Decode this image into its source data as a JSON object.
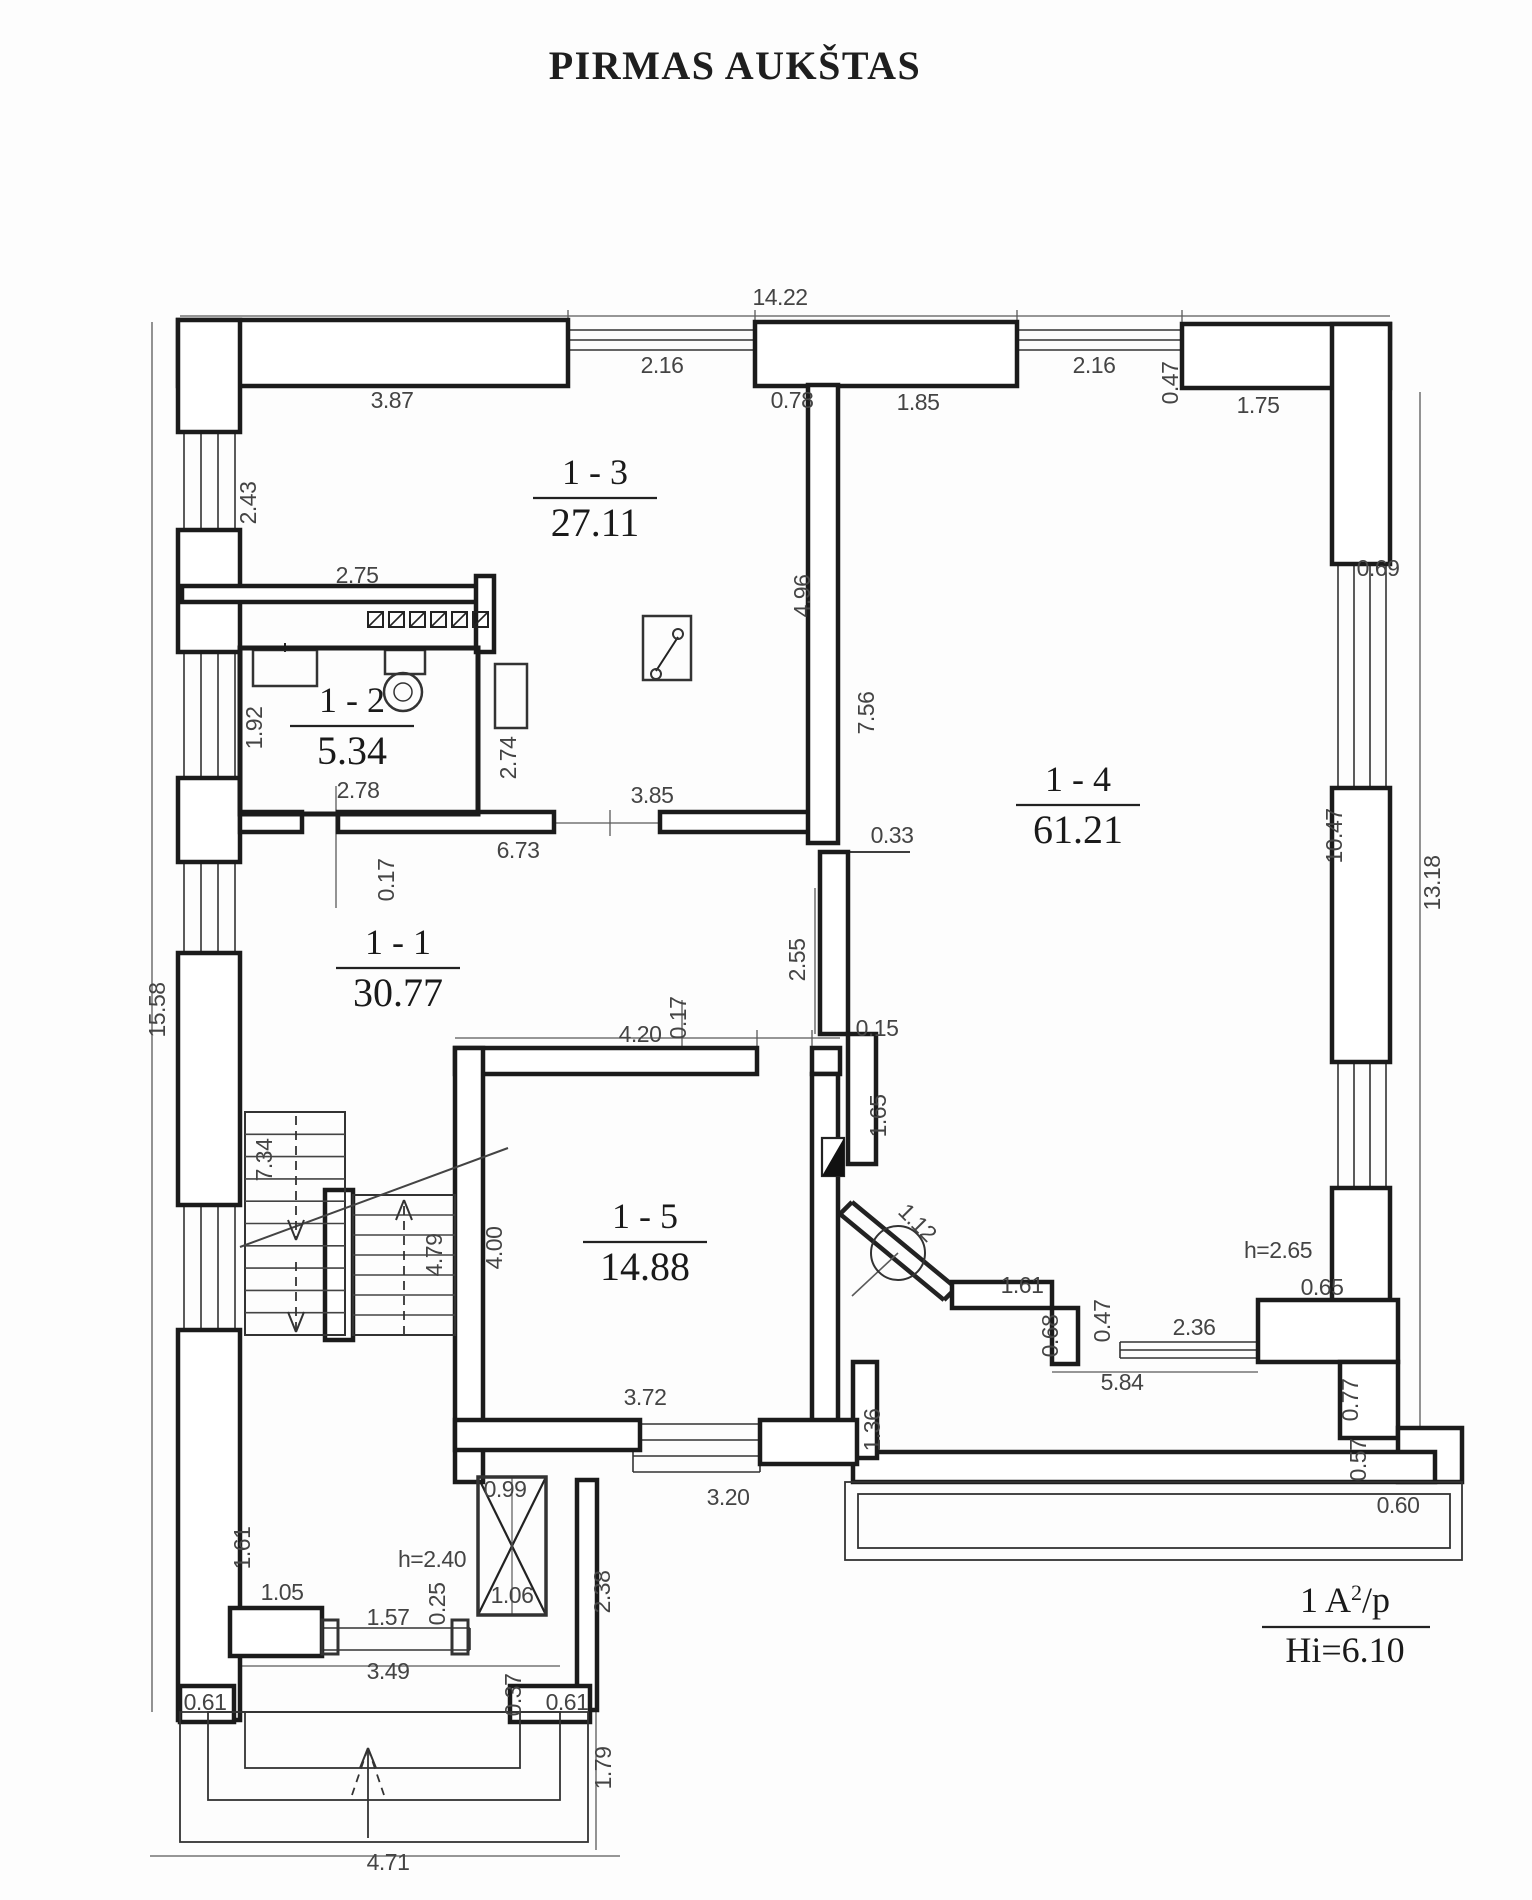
{
  "title": "PIRMAS AUKŠTAS",
  "legend": {
    "l1a": "1  A",
    "l1sup": "2",
    "l1b": "/p",
    "l2": "Hi=6.10"
  },
  "rooms": [
    {
      "name": "1 - 1",
      "area": "30.77",
      "cx": 398,
      "cy": 968
    },
    {
      "name": "1 - 2",
      "area": "5.34",
      "cx": 352,
      "cy": 726
    },
    {
      "name": "1 - 3",
      "area": "27.11",
      "cx": 595,
      "cy": 498
    },
    {
      "name": "1 - 4",
      "area": "61.21",
      "cx": 1078,
      "cy": 805
    },
    {
      "name": "1 - 5",
      "area": "14.88",
      "cx": 645,
      "cy": 1242
    }
  ],
  "dims": [
    {
      "t": "14.22",
      "x": 780,
      "y": 305
    },
    {
      "t": "2.16",
      "x": 662,
      "y": 373
    },
    {
      "t": "0.78",
      "x": 792,
      "y": 408
    },
    {
      "t": "1.85",
      "x": 918,
      "y": 410
    },
    {
      "t": "2.16",
      "x": 1094,
      "y": 373
    },
    {
      "t": "0.47",
      "x": 1178,
      "y": 383,
      "r": -90
    },
    {
      "t": "1.75",
      "x": 1258,
      "y": 413
    },
    {
      "t": "3.87",
      "x": 392,
      "y": 408
    },
    {
      "t": "2.43",
      "x": 256,
      "y": 503,
      "r": -90
    },
    {
      "t": "2.75",
      "x": 357,
      "y": 583
    },
    {
      "t": "1.92",
      "x": 262,
      "y": 728,
      "r": -90
    },
    {
      "t": "2.74",
      "x": 516,
      "y": 758,
      "r": -90
    },
    {
      "t": "2.78",
      "x": 358,
      "y": 798
    },
    {
      "t": "3.85",
      "x": 652,
      "y": 803
    },
    {
      "t": "6.73",
      "x": 518,
      "y": 858
    },
    {
      "t": "0.17",
      "x": 394,
      "y": 880,
      "r": -90
    },
    {
      "t": "4.96",
      "x": 810,
      "y": 596,
      "r": -90
    },
    {
      "t": "7.56",
      "x": 874,
      "y": 713,
      "r": -90
    },
    {
      "t": "0.33",
      "x": 892,
      "y": 843
    },
    {
      "t": "2.55",
      "x": 805,
      "y": 960,
      "r": -90
    },
    {
      "t": "0.69",
      "x": 1378,
      "y": 576
    },
    {
      "t": "10.47",
      "x": 1342,
      "y": 836,
      "r": -90
    },
    {
      "t": "13.18",
      "x": 1440,
      "y": 883,
      "r": -90
    },
    {
      "t": "15.58",
      "x": 165,
      "y": 1010,
      "r": -90
    },
    {
      "t": "0.17",
      "x": 686,
      "y": 1018,
      "r": -90
    },
    {
      "t": "4.20",
      "x": 640,
      "y": 1042
    },
    {
      "t": "0.15",
      "x": 877,
      "y": 1036
    },
    {
      "t": "1.65",
      "x": 886,
      "y": 1116,
      "r": -90
    },
    {
      "t": "1.12",
      "x": 912,
      "y": 1228,
      "r": 45
    },
    {
      "t": "4.00",
      "x": 502,
      "y": 1248,
      "r": -90
    },
    {
      "t": "4.79",
      "x": 442,
      "y": 1255,
      "r": -90
    },
    {
      "t": "7.34",
      "x": 272,
      "y": 1160,
      "r": -90
    },
    {
      "t": "h=2.65",
      "x": 1278,
      "y": 1258
    },
    {
      "t": "1.61",
      "x": 1022,
      "y": 1293
    },
    {
      "t": "0.65",
      "x": 1322,
      "y": 1295
    },
    {
      "t": "0.68",
      "x": 1058,
      "y": 1336,
      "r": -90
    },
    {
      "t": "0.47",
      "x": 1110,
      "y": 1321,
      "r": -90
    },
    {
      "t": "2.36",
      "x": 1194,
      "y": 1335
    },
    {
      "t": "5.84",
      "x": 1122,
      "y": 1390
    },
    {
      "t": "0.77",
      "x": 1358,
      "y": 1400,
      "r": -90
    },
    {
      "t": "0.57",
      "x": 1366,
      "y": 1460,
      "r": -90
    },
    {
      "t": "0.60",
      "x": 1398,
      "y": 1513
    },
    {
      "t": "1.36",
      "x": 880,
      "y": 1430,
      "r": -90
    },
    {
      "t": "3.72",
      "x": 645,
      "y": 1405
    },
    {
      "t": "3.20",
      "x": 728,
      "y": 1505
    },
    {
      "t": "0.99",
      "x": 505,
      "y": 1497
    },
    {
      "t": "h=2.40",
      "x": 432,
      "y": 1567
    },
    {
      "t": "0.25",
      "x": 445,
      "y": 1604,
      "r": -90
    },
    {
      "t": "1.06",
      "x": 512,
      "y": 1603
    },
    {
      "t": "2.38",
      "x": 610,
      "y": 1592,
      "r": -90
    },
    {
      "t": "1.61",
      "x": 250,
      "y": 1548,
      "r": -90
    },
    {
      "t": "1.05",
      "x": 282,
      "y": 1600
    },
    {
      "t": "1.57",
      "x": 388,
      "y": 1625
    },
    {
      "t": "3.49",
      "x": 388,
      "y": 1679
    },
    {
      "t": "0.61",
      "x": 205,
      "y": 1710
    },
    {
      "t": "0.37",
      "x": 521,
      "y": 1695,
      "r": -90
    },
    {
      "t": "0.61",
      "x": 567,
      "y": 1710
    },
    {
      "t": "1.79",
      "x": 611,
      "y": 1768,
      "r": -90
    },
    {
      "t": "4.71",
      "x": 388,
      "y": 1870
    }
  ],
  "geometry": {
    "bands": [
      [
        178,
        320,
        390,
        66
      ],
      [
        755,
        322,
        262,
        64
      ],
      [
        1182,
        324,
        208,
        64
      ],
      [
        1332,
        324,
        58,
        240
      ],
      [
        1332,
        788,
        58,
        274
      ],
      [
        1332,
        1188,
        58,
        114
      ],
      [
        1258,
        1300,
        140,
        62
      ],
      [
        1340,
        1362,
        58,
        76
      ],
      [
        1398,
        1428,
        64,
        54
      ],
      [
        853,
        1452,
        582,
        30
      ],
      [
        853,
        1362,
        24,
        96
      ],
      [
        178,
        320,
        62,
        112
      ],
      [
        178,
        530,
        62,
        122
      ],
      [
        178,
        778,
        62,
        84
      ],
      [
        178,
        953,
        62,
        252
      ],
      [
        178,
        1330,
        62,
        390
      ],
      [
        182,
        586,
        310,
        16
      ],
      [
        476,
        576,
        18,
        76
      ],
      [
        240,
        812,
        62,
        20
      ],
      [
        338,
        812,
        216,
        20
      ],
      [
        660,
        812,
        150,
        20
      ],
      [
        808,
        385,
        30,
        458
      ],
      [
        820,
        852,
        28,
        182
      ],
      [
        848,
        1034,
        28,
        130
      ],
      [
        952,
        1282,
        100,
        26
      ],
      [
        1052,
        1308,
        26,
        56
      ],
      [
        455,
        1048,
        302,
        26
      ],
      [
        812,
        1048,
        28,
        26
      ],
      [
        455,
        1048,
        28,
        434
      ],
      [
        812,
        1074,
        26,
        348
      ],
      [
        455,
        1420,
        185,
        30
      ],
      [
        760,
        1420,
        97,
        44
      ],
      [
        230,
        1608,
        92,
        48
      ],
      [
        577,
        1480,
        20,
        230
      ],
      [
        180,
        1686,
        54,
        36
      ],
      [
        510,
        1686,
        80,
        36
      ],
      [
        325,
        1190,
        28,
        150
      ]
    ],
    "windows": [
      {
        "o": "h",
        "a": 568,
        "b": 755,
        "p": 330,
        "n": 3,
        "g": 10
      },
      {
        "o": "h",
        "a": 1017,
        "b": 1182,
        "p": 330,
        "n": 3,
        "g": 10
      },
      {
        "o": "v",
        "a": 432,
        "b": 530,
        "p": 184,
        "n": 4,
        "g": 17
      },
      {
        "o": "v",
        "a": 652,
        "b": 778,
        "p": 184,
        "n": 4,
        "g": 17
      },
      {
        "o": "v",
        "a": 862,
        "b": 953,
        "p": 184,
        "n": 4,
        "g": 17
      },
      {
        "o": "v",
        "a": 1205,
        "b": 1330,
        "p": 184,
        "n": 4,
        "g": 17
      },
      {
        "o": "v",
        "a": 564,
        "b": 788,
        "p": 1338,
        "n": 4,
        "g": 16
      },
      {
        "o": "v",
        "a": 1062,
        "b": 1188,
        "p": 1338,
        "n": 4,
        "g": 16
      },
      {
        "o": "h",
        "a": 1120,
        "b": 1258,
        "p": 1342,
        "n": 3,
        "g": 8
      },
      {
        "o": "h",
        "a": 633,
        "b": 760,
        "p": 1424,
        "n": 4,
        "g": 16
      },
      {
        "o": "h",
        "a": 322,
        "b": 470,
        "p": 1628,
        "n": 2,
        "g": 22
      }
    ],
    "lines": [
      [
        152,
        322,
        152,
        1712,
        1.3
      ],
      [
        180,
        316,
        1390,
        316,
        1.3
      ],
      [
        568,
        310,
        568,
        322,
        1.3
      ],
      [
        755,
        310,
        755,
        322,
        1.3
      ],
      [
        1017,
        310,
        1017,
        322,
        1.3
      ],
      [
        1182,
        310,
        1182,
        322,
        1.3
      ],
      [
        1420,
        392,
        1420,
        1455,
        1.3
      ],
      [
        336,
        786,
        336,
        908,
        1.3
      ],
      [
        815,
        888,
        815,
        1034,
        1.3
      ],
      [
        682,
        1000,
        682,
        1050,
        1.3
      ],
      [
        455,
        1038,
        840,
        1038,
        1.3
      ],
      [
        757,
        1030,
        757,
        1046,
        1.3
      ],
      [
        812,
        1030,
        812,
        1046,
        1.3
      ],
      [
        553,
        823,
        660,
        823,
        1.3
      ],
      [
        610,
        810,
        610,
        836,
        1.3
      ],
      [
        1052,
        1372,
        1258,
        1372,
        1.3
      ],
      [
        150,
        1856,
        620,
        1856,
        1.3
      ],
      [
        596,
        1692,
        596,
        1850,
        1.3
      ],
      [
        233,
        1666,
        560,
        1666,
        1.2
      ],
      [
        848,
        852,
        910,
        852,
        1.8
      ],
      [
        852,
        1202,
        956,
        1288,
        4.5
      ],
      [
        840,
        1214,
        944,
        1300,
        4.5
      ],
      [
        852,
        1202,
        840,
        1214,
        4.5
      ],
      [
        956,
        1288,
        944,
        1300,
        4.5
      ],
      [
        852,
        1296,
        898,
        1253,
        1.6
      ],
      [
        656,
        671,
        678,
        637,
        2
      ],
      [
        285,
        643,
        285,
        652,
        2
      ],
      [
        478,
        1477,
        546,
        1615,
        2.2
      ],
      [
        546,
        1477,
        478,
        1615,
        2.2
      ],
      [
        512,
        1477,
        512,
        1615,
        1.2
      ]
    ],
    "thinrects": [
      [
        845,
        1482,
        617,
        78,
        1.8
      ],
      [
        858,
        1494,
        592,
        54,
        1.8
      ],
      [
        180,
        1712,
        408,
        130,
        1.8
      ],
      [
        208,
        1712,
        352,
        88,
        1.8
      ],
      [
        245,
        1712,
        275,
        56,
        1.8
      ],
      [
        643,
        616,
        48,
        64,
        2.5
      ],
      [
        253,
        650,
        64,
        36,
        2.5
      ],
      [
        385,
        650,
        40,
        24,
        2.5
      ],
      [
        495,
        664,
        32,
        64,
        2.5
      ],
      [
        478,
        1477,
        68,
        138,
        3.5
      ],
      [
        322,
        1620,
        16,
        34,
        3
      ],
      [
        452,
        1620,
        16,
        34,
        3
      ],
      [
        240,
        648,
        238,
        166,
        5
      ]
    ],
    "hatches": {
      "y": 612,
      "s": 15,
      "xs": [
        368,
        389,
        410,
        431,
        452,
        473
      ]
    },
    "stairs": [
      {
        "x": 245,
        "y": 1112,
        "w": 100,
        "h": 223,
        "treads": 9
      },
      {
        "x": 353,
        "y": 1195,
        "w": 102,
        "h": 140,
        "treads": 6
      }
    ],
    "arrows": [
      {
        "x": 296,
        "y1": 1116,
        "y2": 1240,
        "tip": "down",
        "dash": true
      },
      {
        "x": 296,
        "y1": 1262,
        "y2": 1332,
        "tip": "down",
        "dash": true
      },
      {
        "x": 404,
        "y1": 1335,
        "y2": 1200,
        "tip": "up",
        "dash": true
      },
      {
        "x": 368,
        "y1": 1838,
        "y2": 1748,
        "tip": "up",
        "dash": false,
        "vlegs": true
      }
    ],
    "circles": [
      [
        898,
        1253,
        27,
        2
      ],
      [
        403,
        692,
        19,
        2.5
      ],
      [
        403,
        692,
        9,
        1.5
      ],
      [
        678,
        634,
        5,
        2
      ],
      [
        656,
        674,
        5,
        2
      ]
    ],
    "doorleaf": {
      "rect": [
        822,
        1138,
        22,
        38
      ],
      "pts": "822,1176 844,1138 844,1176"
    },
    "legend_pos": {
      "cx": 1345,
      "y1": 1612,
      "liney": 1627,
      "lx1": 1262,
      "lx2": 1430,
      "y2": 1662
    }
  },
  "colors": {
    "wall": "#1b1b1b",
    "thin": "#333333",
    "dim": "#444444",
    "dimline": "#5a5a5a",
    "text": "#1a1a1a"
  }
}
